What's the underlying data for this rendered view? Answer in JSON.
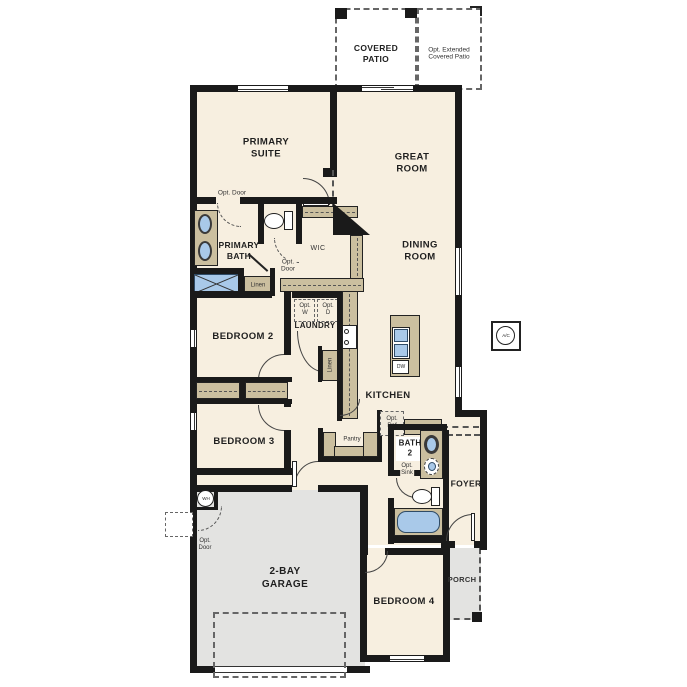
{
  "floorplan": {
    "title": "Single-story 2-bay garage floor plan",
    "colors": {
      "room_fill": "#f7efe0",
      "outdoor_fill": "#e3e3e1",
      "wall": "#1a1a1a",
      "cabinet_tan": "#cbbf9f",
      "fixture_blue": "#a9c9e9"
    },
    "labels": {
      "covered_patio": "COVERED\nPATIO",
      "ext_patio": "Opt. Extended\nCovered Patio",
      "primary_suite": "PRIMARY\nSUITE",
      "great_room": "GREAT\nROOM",
      "dining_room": "DINING\nROOM",
      "primary_bath": "PRIMARY\nBATH",
      "wic": "WIC",
      "opt_door_suite": "Opt. Door",
      "opt_door_wic": "Opt.\nDoor",
      "opt_door_garage": "Opt.\nDoor",
      "linen_bath": "Linen",
      "linen_hall": "Linen",
      "bedroom_2": "BEDROOM 2",
      "bedroom_3": "BEDROOM 3",
      "bedroom_4": "BEDROOM 4",
      "laundry": "LAUNDRY",
      "opt_w": "Opt.\nW",
      "opt_d": "Opt.\nD",
      "kitchen": "KITCHEN",
      "dw": "DW",
      "pantry": "Pantry",
      "opt_ref": "Opt.\nRef",
      "bath_2": "BATH\n2",
      "opt_sink": "Opt.\nSink",
      "foyer": "FOYER",
      "garage": "2-BAY\nGARAGE",
      "porch": "PORCH",
      "wh": "WH",
      "ac": "A/C"
    }
  }
}
